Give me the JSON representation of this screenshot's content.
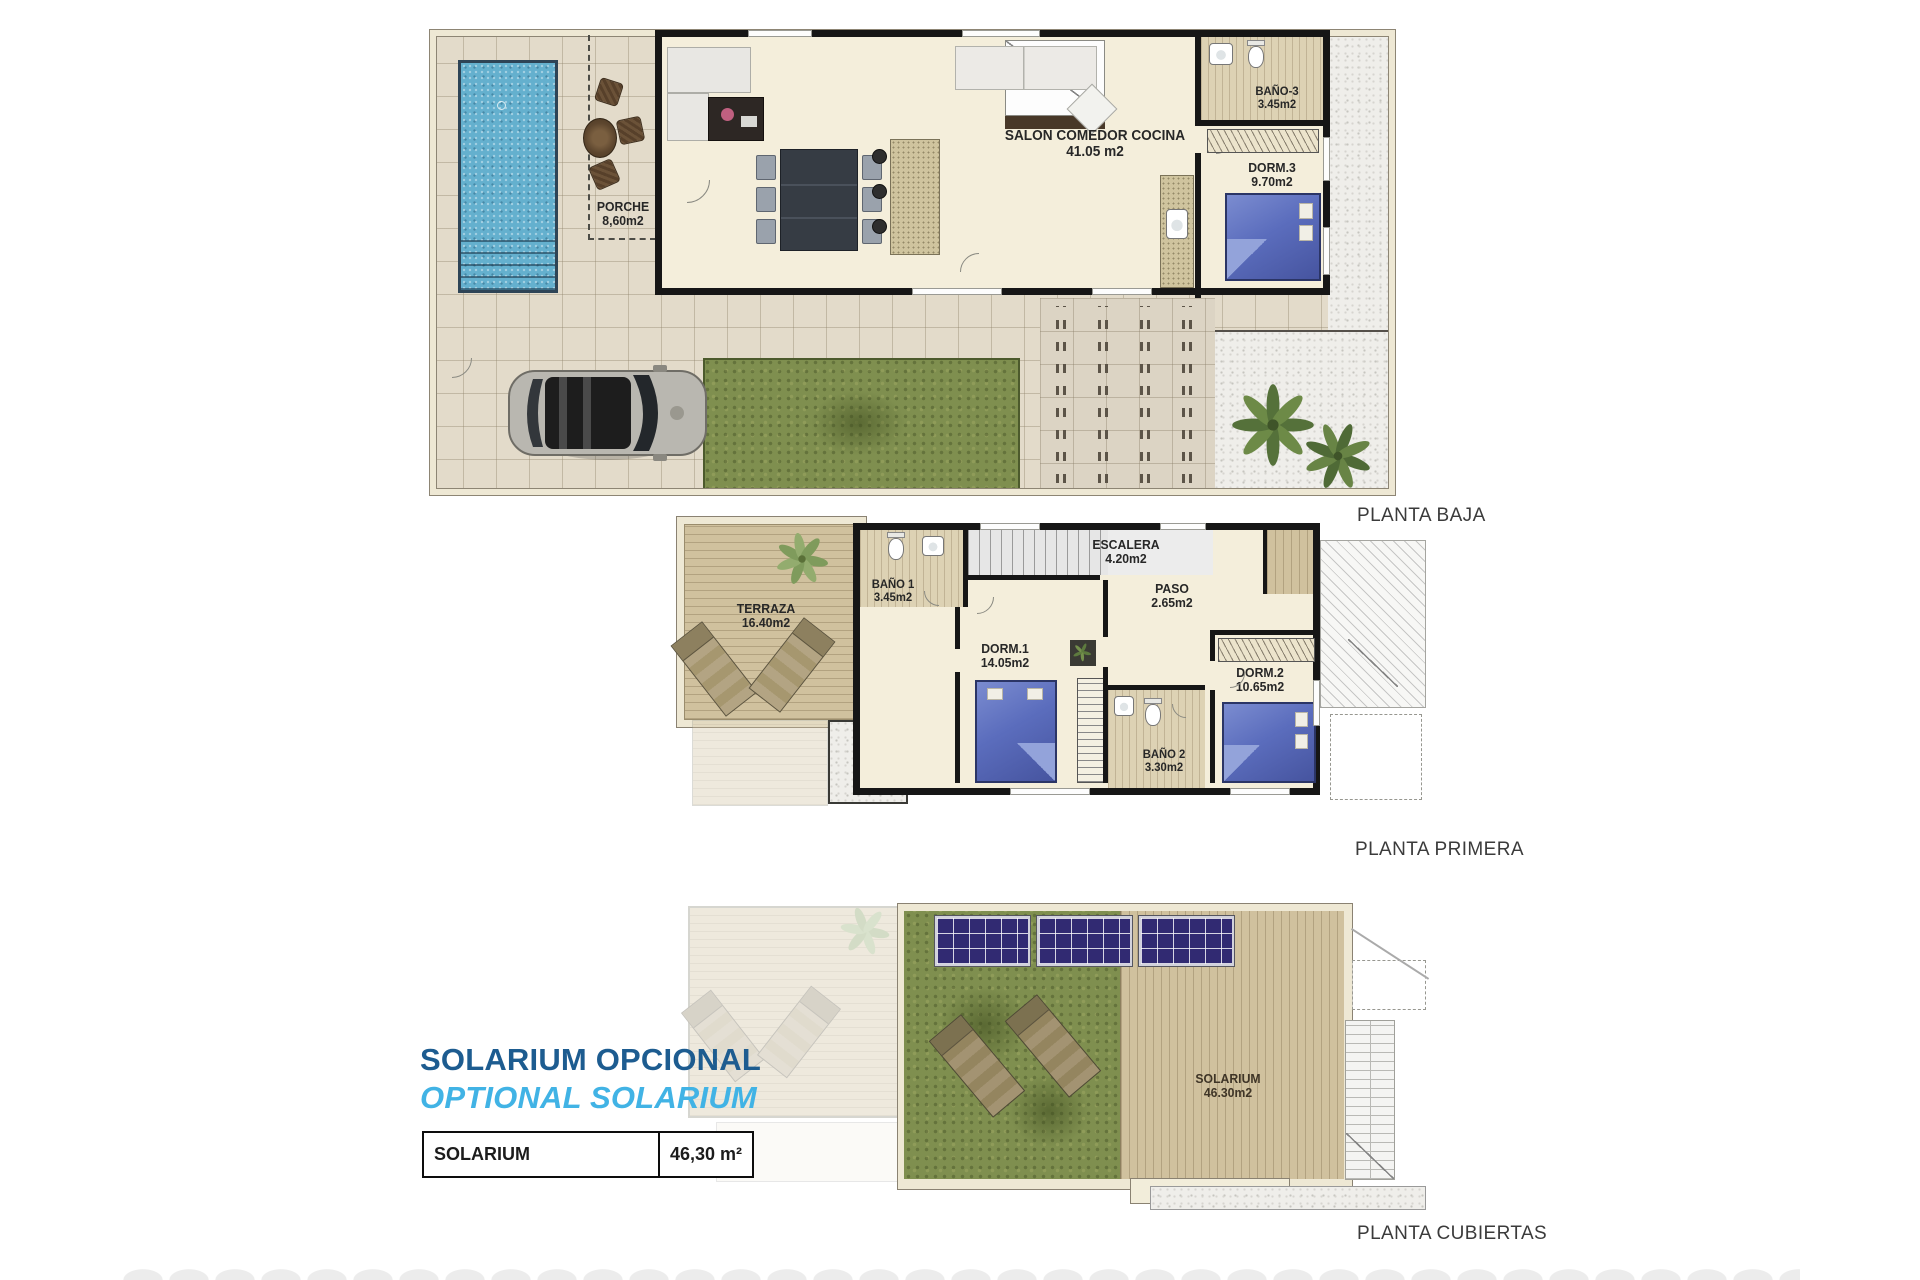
{
  "document": {
    "type": "architectural floor plan sheet"
  },
  "plans": [
    {
      "title": "PLANTA BAJA",
      "rooms": [
        {
          "name": "PORCHE",
          "area": "8,60m2"
        },
        {
          "name": "SALON COMEDOR COCINA",
          "area": "41.05 m2"
        },
        {
          "name": "BAÑO-3",
          "area": "3.45m2"
        },
        {
          "name": "DORM.3",
          "area": "9.70m2"
        }
      ]
    },
    {
      "title": "PLANTA PRIMERA",
      "rooms": [
        {
          "name": "TERRAZA",
          "area": "16.40m2"
        },
        {
          "name": "BAÑO 1",
          "area": "3.45m2"
        },
        {
          "name": "ESCALERA",
          "area": "4.20m2"
        },
        {
          "name": "PASO",
          "area": "2.65m2"
        },
        {
          "name": "DORM.1",
          "area": "14.05m2"
        },
        {
          "name": "DORM.2",
          "area": "10.65m2"
        },
        {
          "name": "BAÑO 2",
          "area": "3.30m2"
        }
      ]
    },
    {
      "title": "PLANTA CUBIERTAS",
      "rooms": [
        {
          "name": "SOLARIUM",
          "area": "46.30m2"
        }
      ]
    }
  ],
  "optional_solarium": {
    "heading_es": "SOLARIUM OPCIONAL",
    "heading_en": "OPTIONAL SOLARIUM",
    "table": {
      "label": "SOLARIUM",
      "value": "46,30 m²"
    }
  },
  "colors": {
    "heading_dark_blue": "#1d5c90",
    "heading_light_blue": "#41b3e5",
    "pool_blue": "#64b0ce",
    "grass_green": "#7f8f4f",
    "wood_deck": "#d0c19e",
    "wall_black": "#161616",
    "bed_blue": "#5b6dbd",
    "solar_panel": "#312a72"
  }
}
